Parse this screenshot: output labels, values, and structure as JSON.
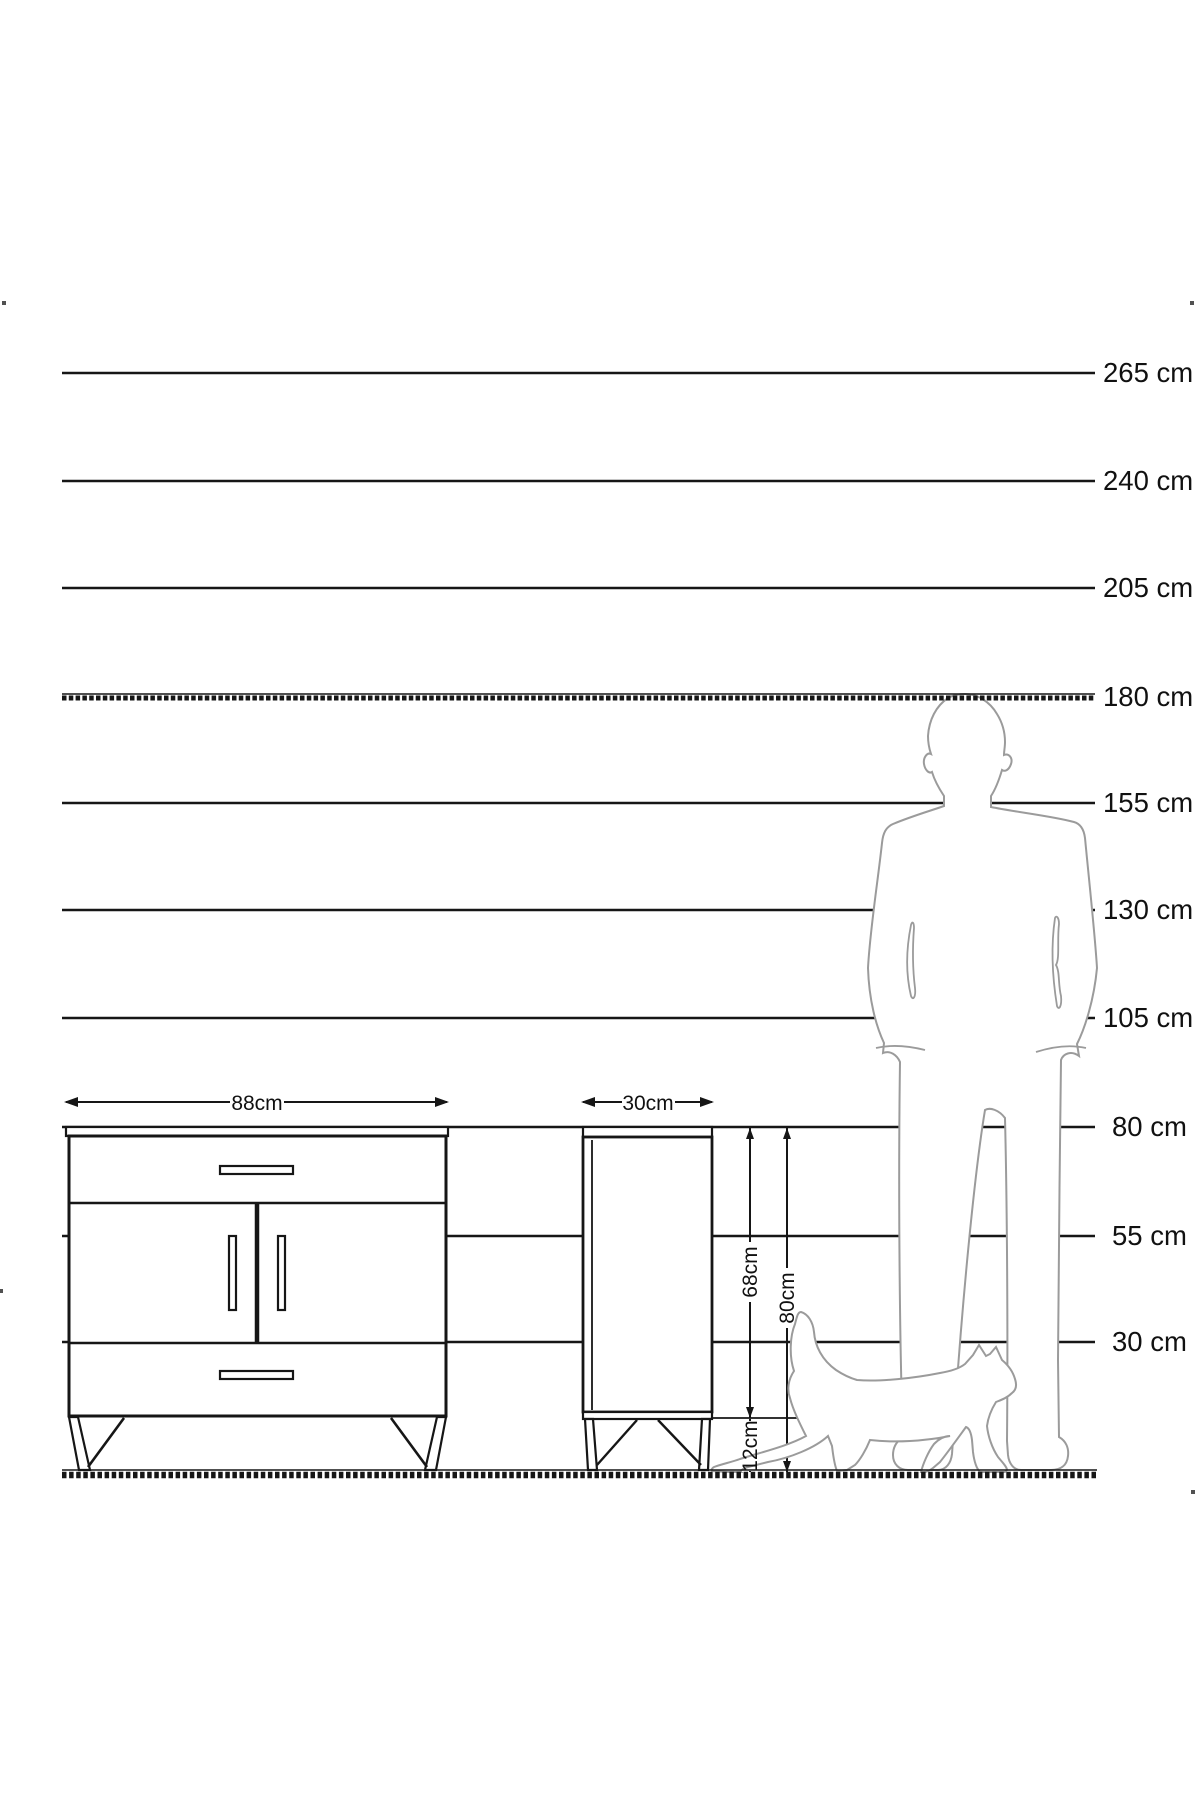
{
  "ruler": {
    "unit": "cm",
    "labels": [
      "265 cm",
      "240 cm",
      "205 cm",
      "180 cm",
      "155 cm",
      "130 cm",
      "105 cm",
      "80 cm",
      "55 cm",
      "30 cm"
    ],
    "values": [
      265,
      240,
      205,
      180,
      155,
      130,
      105,
      80,
      55,
      30
    ],
    "dashed_value": 180,
    "line_color": "#161616",
    "label_color": "#111111"
  },
  "front_cabinet": {
    "width_label": "88cm"
  },
  "side_cabinet": {
    "width_label": "30cm"
  },
  "dimensions": {
    "body_height_label": "68cm",
    "total_height_label": "80cm",
    "leg_height_label": "12cm"
  },
  "figures": {
    "man_icon": "man-silhouette",
    "cat_icon": "cat-silhouette",
    "silhouette_color": "#9b9b9b"
  }
}
